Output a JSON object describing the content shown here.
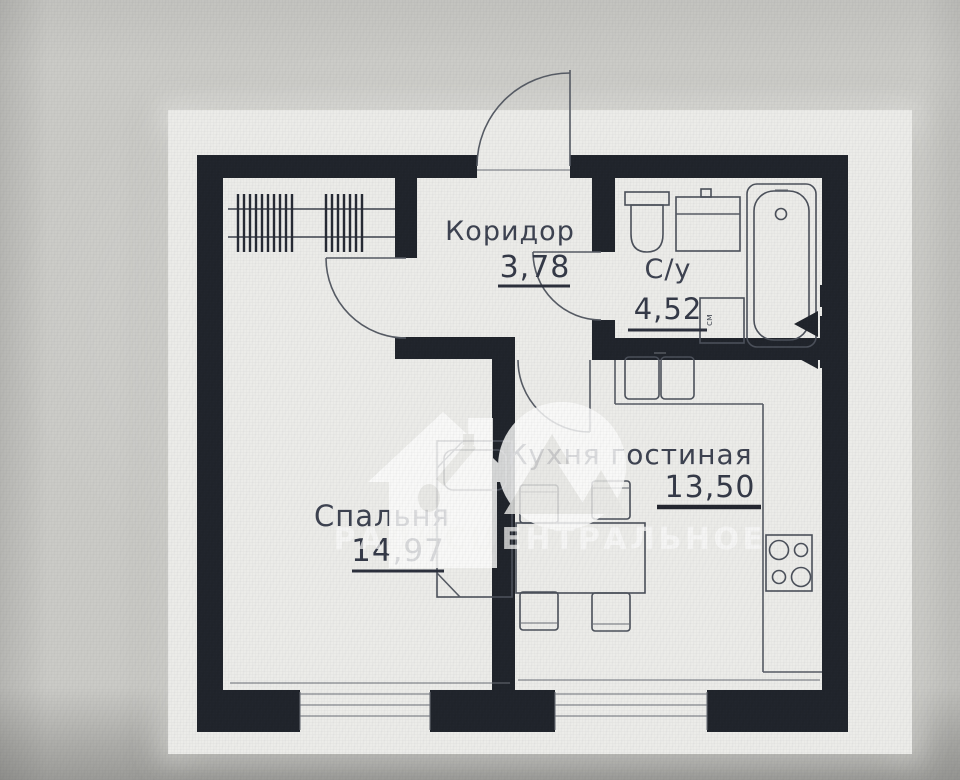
{
  "photo": {
    "backdrop_color": "#cbcbc7",
    "page_color": "#ecece9"
  },
  "plan": {
    "rooms": [
      {
        "name": "Коридор",
        "area": "3,78"
      },
      {
        "name": "С/у",
        "area": "4,52"
      },
      {
        "name": "Спальня",
        "area": "14,97"
      },
      {
        "name": "Кухня гостиная",
        "area": "13,50"
      }
    ],
    "fixtures": {
      "washing_machine_label": "см"
    },
    "watermark": {
      "text": "РАДИСЦЕНТРАЛЬНОЕ",
      "logos": [
        "house-key-logo",
        "mountain-circle-logo"
      ]
    },
    "colors": {
      "wall": "#20242b",
      "line": "#565b64",
      "label_text": "#3d4250",
      "watermark": "#fdfdfc"
    }
  }
}
